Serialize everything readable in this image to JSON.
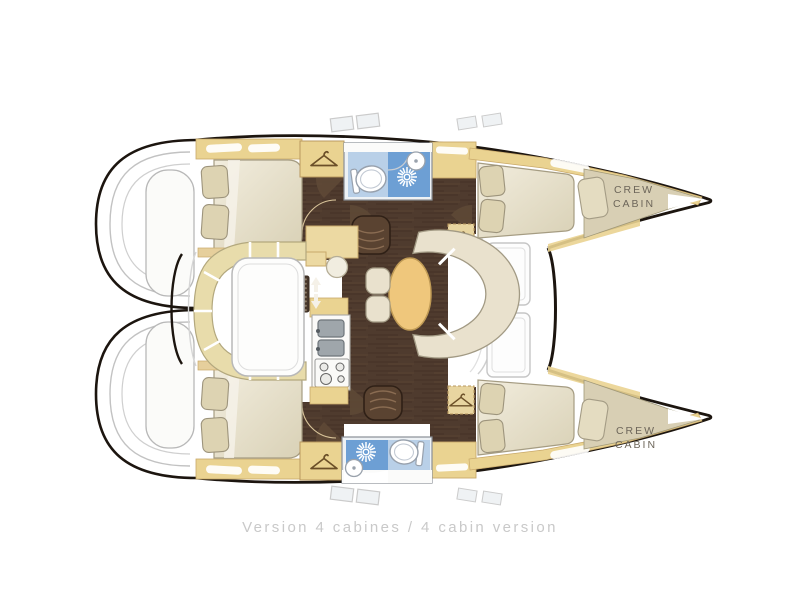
{
  "floorplan": {
    "caption": "Version 4 cabines / 4 cabin version",
    "crew_cabin_top": {
      "line1": "CREW",
      "line2": "CABIN"
    },
    "crew_cabin_bottom": {
      "line1": "CREW",
      "line2": "CABIN"
    },
    "colors": {
      "hull_outline": "#1c150f",
      "wood_floor": "#4f3b2e",
      "cabinetry_beige": "#ead391",
      "cushion_beige": "#e8dcab",
      "upholstery_cream": "#e9e1cd",
      "mattress_cream": "#ece5d3",
      "table_wood": "#efc77c",
      "bathroom_light_blue": "#b9d0e8",
      "shower_blue": "#6d9fd4",
      "crew_area_beige": "#d8cfb4",
      "caption_gray": "#c9c9c9"
    }
  }
}
